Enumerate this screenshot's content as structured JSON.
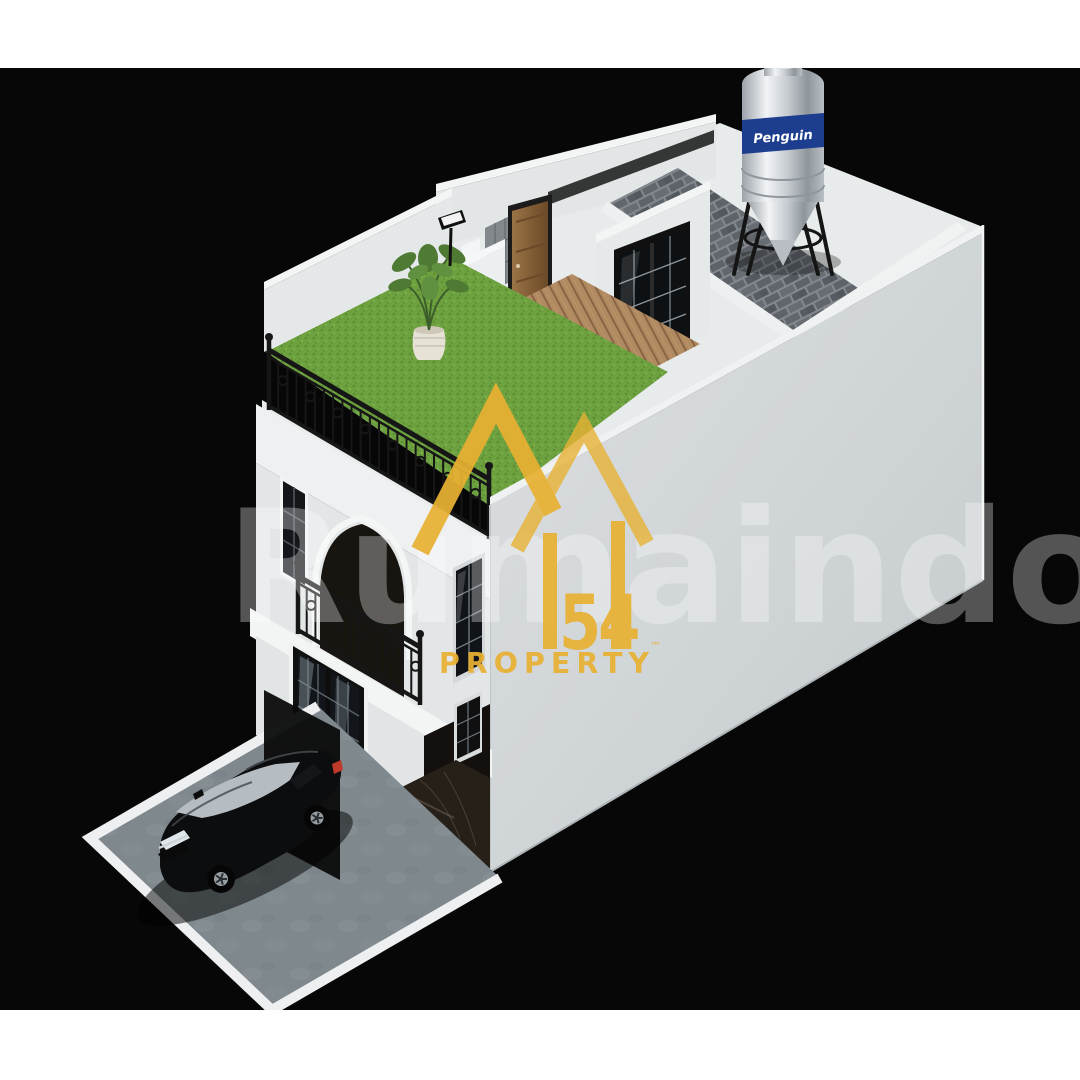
{
  "frame": {
    "background_color": "#FFFFFF",
    "canvas_color": "#070707",
    "canvas_top": 68,
    "canvas_bottom": 1010
  },
  "watermark": {
    "text": "Rumaindo",
    "color": "#FFFFFF",
    "opacity": 0.31
  },
  "logo": {
    "digits": "54",
    "property_label": "PROPERTY",
    "trademark": "™",
    "gold": "#E8B133"
  },
  "water_tank": {
    "brand": "Penguin",
    "band_color": "#1D3E8E"
  },
  "colors": {
    "grass": "#6DA13F",
    "grass_dark": "#5B8C31",
    "grass_light": "#7FB54B",
    "concrete": "#7E888D",
    "wall_light": "#DADDDF",
    "wall_dark": "#C6CBCD",
    "roof_floor": "#E8EBEB",
    "facade": "#E3E6E7",
    "trim_white": "#F2F4F4",
    "iron": "#161616",
    "wood_deck": "#B08A61",
    "door_wood": "#8F6A3F",
    "marble": "#262019",
    "shingle": "#82888D",
    "car_glass": "#B6BDC2",
    "taillight_red": "#BF3A2A"
  }
}
